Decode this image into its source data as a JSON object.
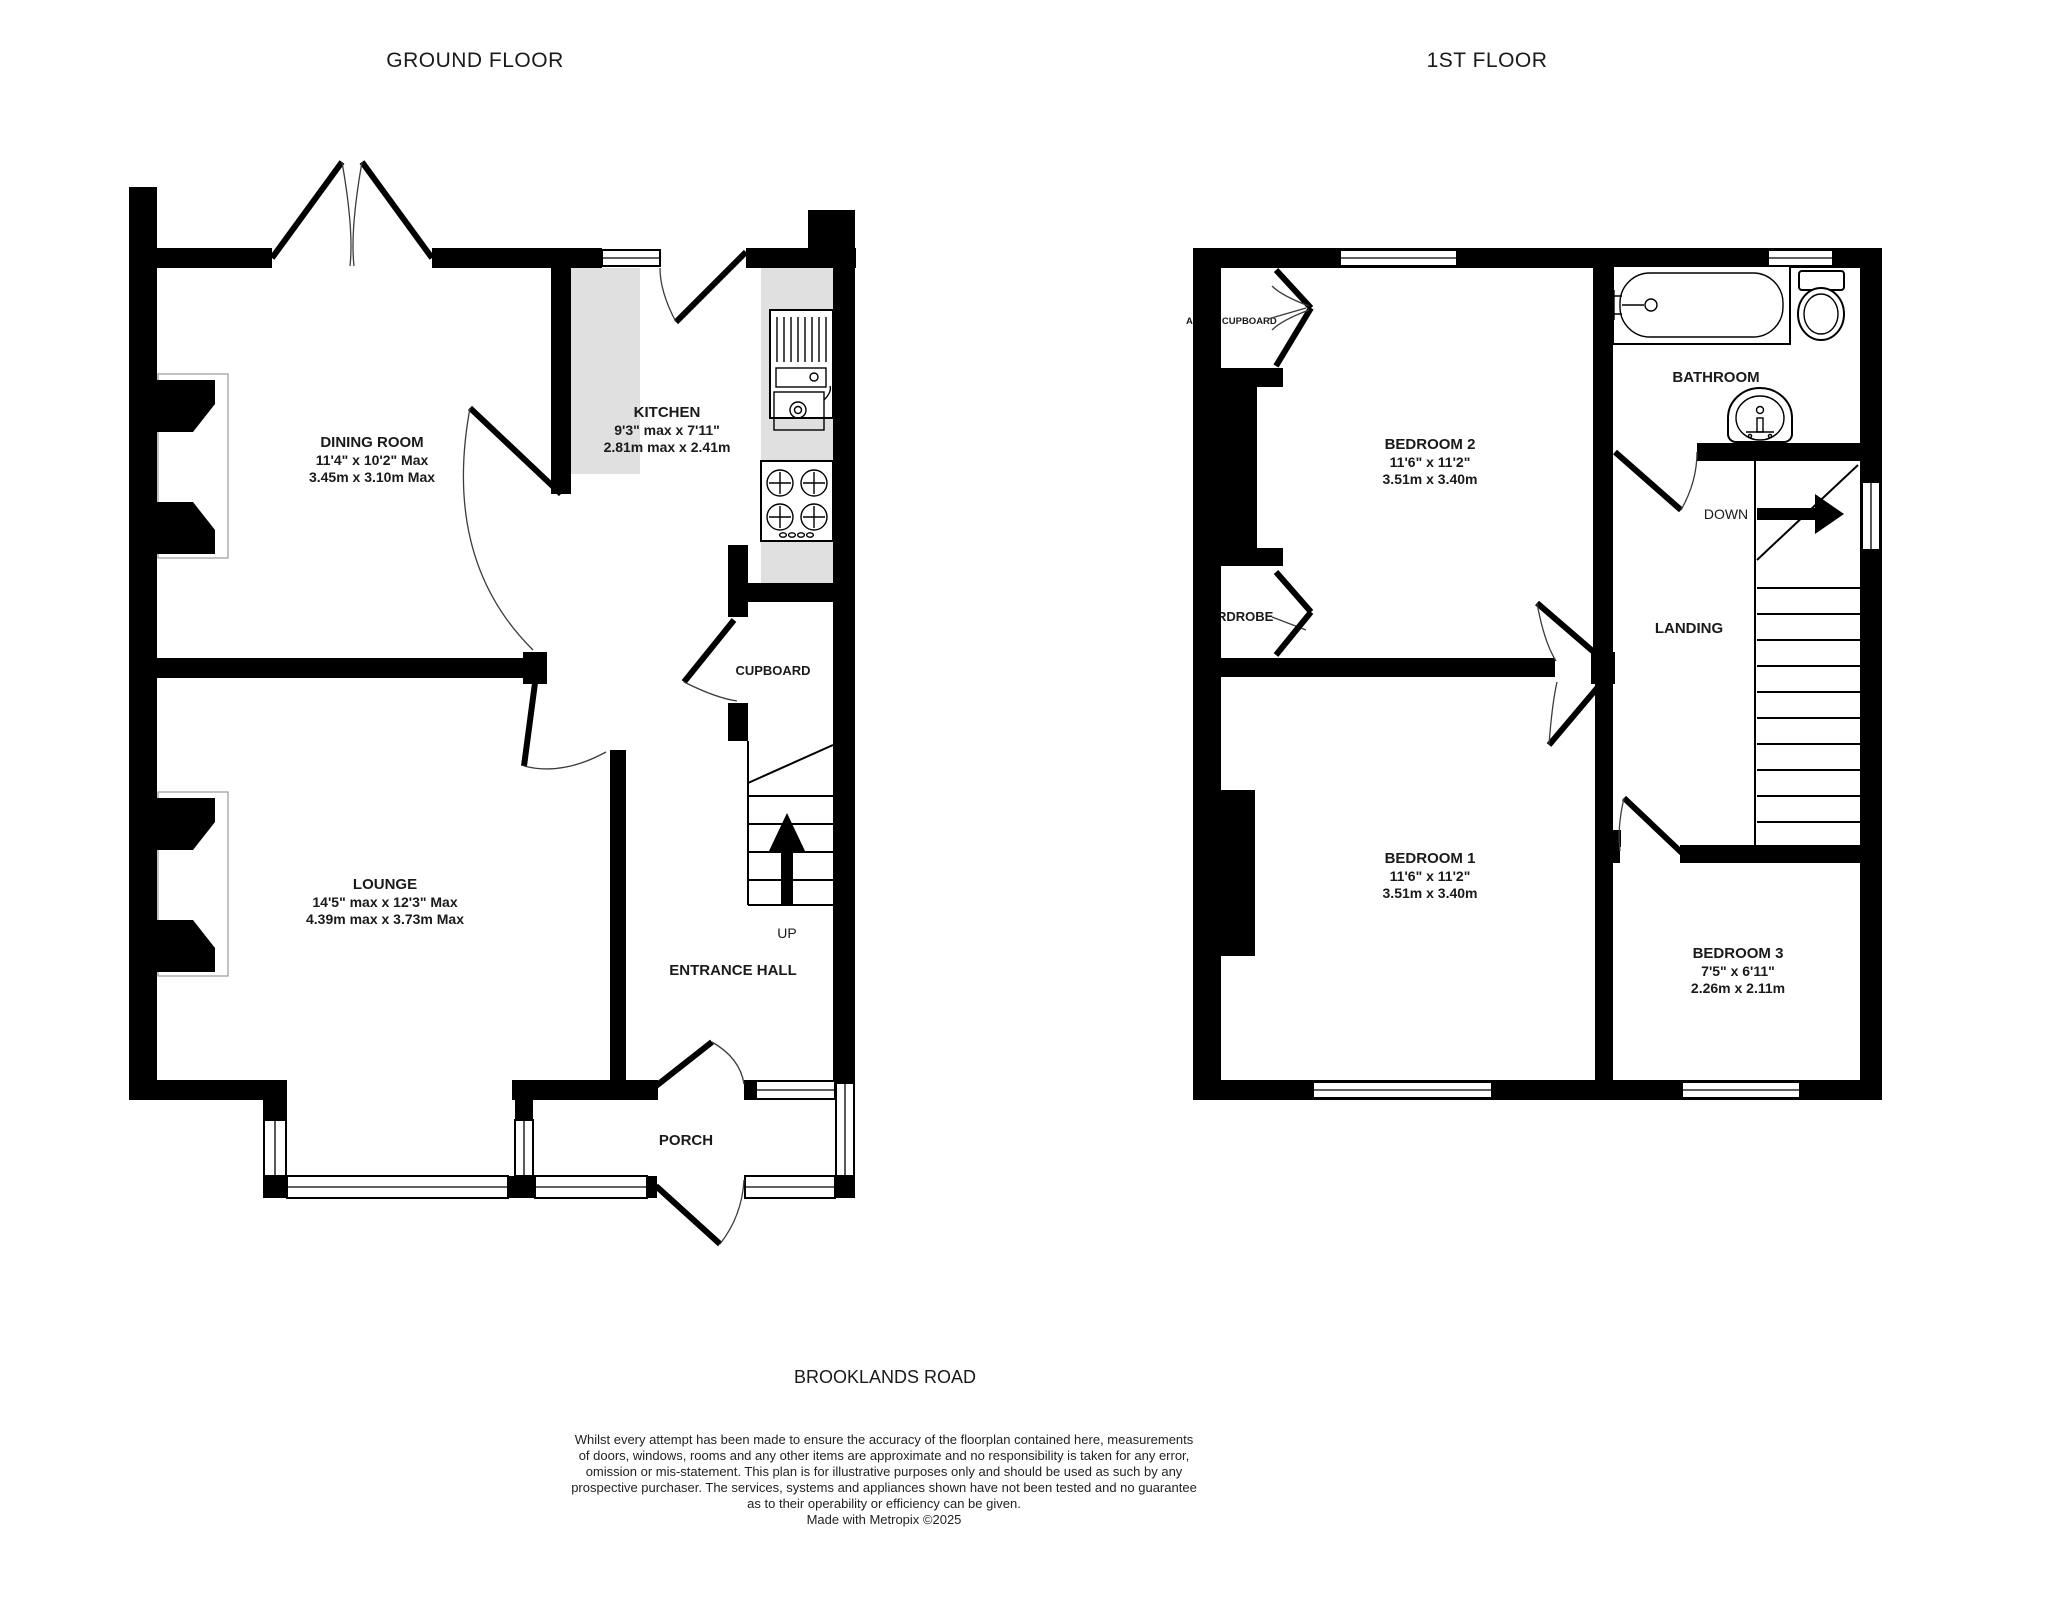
{
  "colors": {
    "wall": "#000000",
    "counter": "#e0e0e0",
    "background": "#ffffff",
    "text": "#1a1a1a"
  },
  "titles": {
    "ground": "GROUND FLOOR",
    "first": "1ST FLOOR"
  },
  "address": "BROOKLANDS ROAD",
  "disclaimer": {
    "line1": "Whilst every attempt has been made to ensure the accuracy of the floorplan contained here, measurements",
    "line2": "of doors, windows, rooms and any other items are approximate and no responsibility is taken for any error,",
    "line3": "omission or mis-statement. This plan is for illustrative purposes only and should be used as such by any",
    "line4": "prospective purchaser. The services, systems and appliances shown have not been tested and no guarantee",
    "line5": "as to their operability or efficiency can be given.",
    "line6": "Made with Metropix ©2025"
  },
  "ground_floor": {
    "dining_room": {
      "name": "DINING ROOM",
      "imperial": "11'4\"  x 10'2\" Max",
      "metric": "3.45m  x 3.10m Max"
    },
    "kitchen": {
      "name": "KITCHEN",
      "imperial": "9'3\" max x 7'11\"",
      "metric": "2.81m max x 2.41m"
    },
    "lounge": {
      "name": "LOUNGE",
      "imperial": "14'5\" max x 12'3\" Max",
      "metric": "4.39m max x 3.73m Max"
    },
    "entrance_hall": {
      "name": "ENTRANCE HALL"
    },
    "porch": {
      "name": "PORCH"
    },
    "cupboard": {
      "name": "CUPBOARD"
    },
    "stairs": {
      "label": "UP"
    }
  },
  "first_floor": {
    "bedroom_2": {
      "name": "BEDROOM 2",
      "imperial": "11'6\"  x 11'2\"",
      "metric": "3.51m  x 3.40m"
    },
    "bedroom_1": {
      "name": "BEDROOM 1",
      "imperial": "11'6\"  x 11'2\"",
      "metric": "3.51m  x 3.40m"
    },
    "bedroom_3": {
      "name": "BEDROOM 3",
      "imperial": "7'5\"  x 6'11\"",
      "metric": "2.26m  x 2.11m"
    },
    "bathroom": {
      "name": "BATHROOM"
    },
    "landing": {
      "name": "LANDING"
    },
    "airing_cupboard": {
      "name": "AIRING CUPBOARD"
    },
    "wardrobe": {
      "name": "WARDROBE"
    },
    "stairs": {
      "label": "DOWN"
    }
  }
}
